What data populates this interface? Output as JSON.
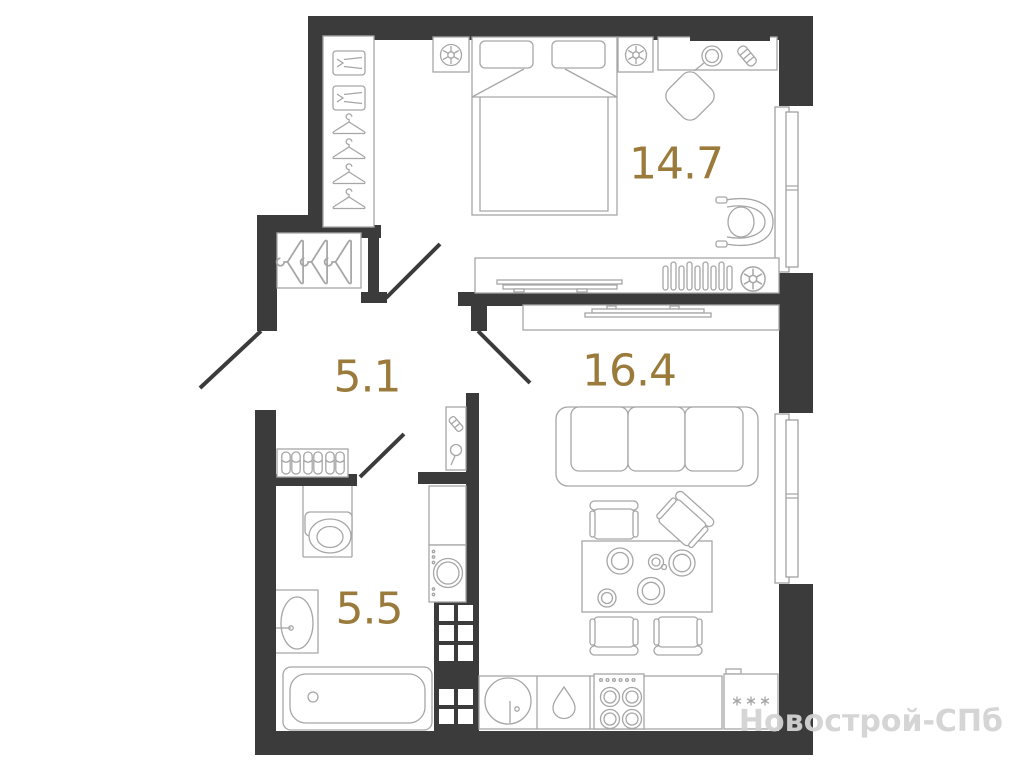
{
  "floor_plan": {
    "room_labels": {
      "bedroom_area": "14.7",
      "hallway_area": "5.1",
      "living_kitchen_area": "16.4",
      "bathroom_area": "5.5"
    },
    "watermark": "Новострой-СПб",
    "colors": {
      "wall": "#3b3b3b",
      "area_label": "#9a7b3c",
      "furniture_line": "#a6a6a6",
      "watermark": "#d3d3d3",
      "background": "#ffffff"
    }
  }
}
